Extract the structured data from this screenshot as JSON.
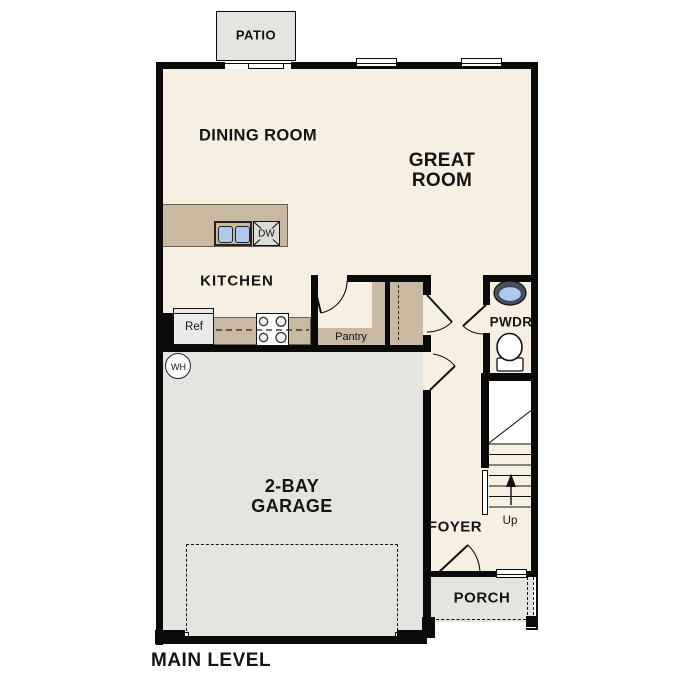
{
  "plan_title": "MAIN LEVEL",
  "colors": {
    "floor_cream": "#F6EFE2",
    "room_gray": "#E5E4E0",
    "counter_tan": "#C9B9A1",
    "sink_blue": "#AEC9EB",
    "wall_black": "#0A0A0A"
  },
  "rooms": {
    "patio": {
      "label": "PATIO"
    },
    "dining_room": {
      "label": "DINING ROOM"
    },
    "great_room": {
      "label_line1": "GREAT",
      "label_line2": "ROOM"
    },
    "kitchen": {
      "label": "KITCHEN"
    },
    "pantry": {
      "label": "Pantry"
    },
    "powder_room": {
      "label": "PWDR"
    },
    "foyer": {
      "label": "FOYER"
    },
    "porch": {
      "label": "PORCH"
    },
    "garage": {
      "label_line1": "2-BAY",
      "label_line2": "GARAGE"
    }
  },
  "fixtures": {
    "refrigerator_label": "Ref",
    "dishwasher_label": "DW",
    "water_heater_label": "WH",
    "stairs_label": "Up"
  }
}
